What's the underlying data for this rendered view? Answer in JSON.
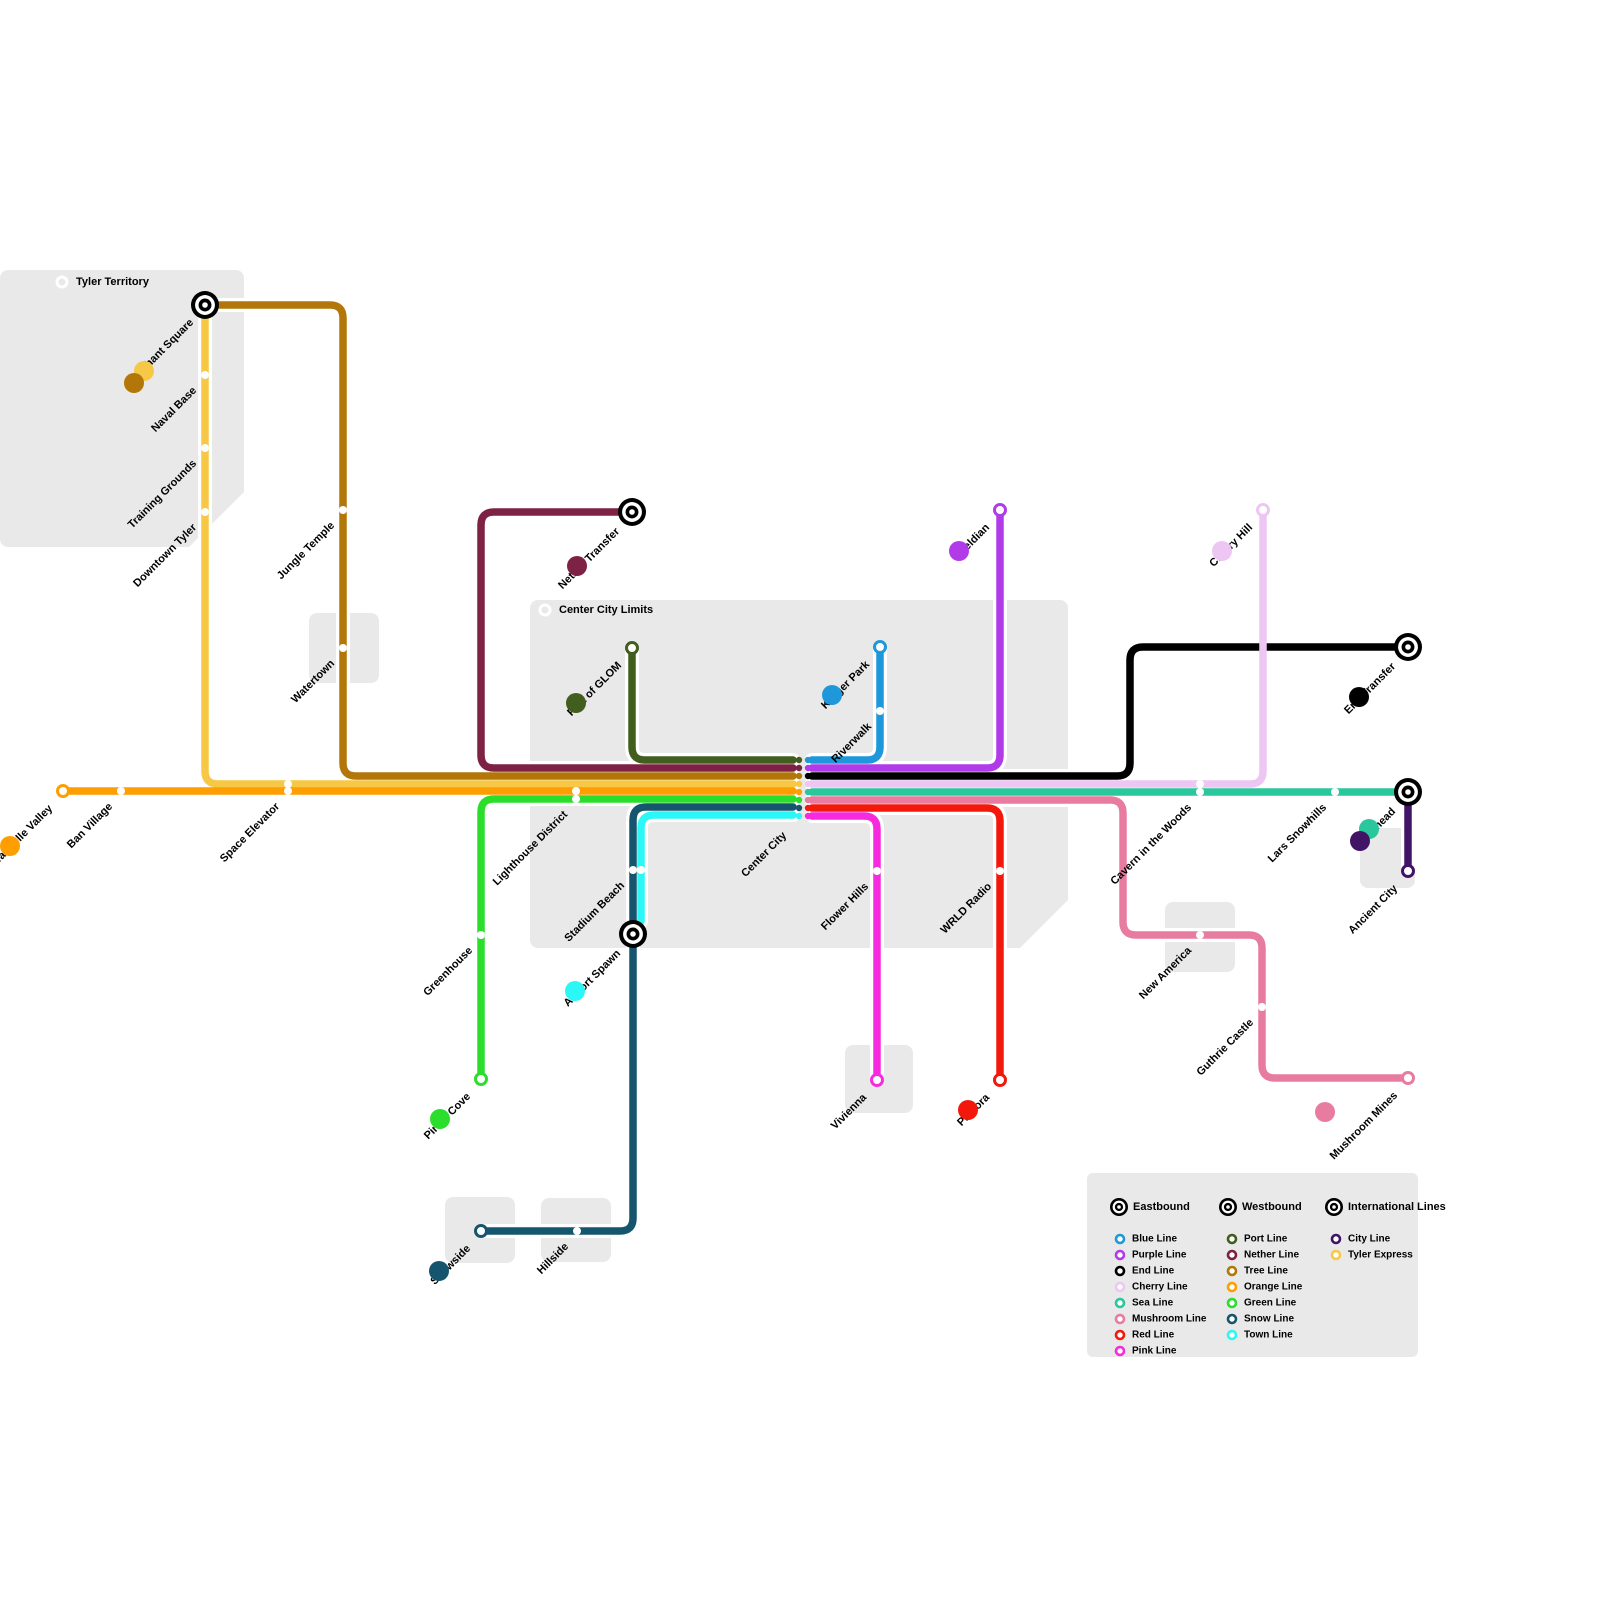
{
  "canvas": {
    "width": 1600,
    "height": 1600,
    "background": "#ffffff",
    "region_fill": "#e9e9e9"
  },
  "colors": {
    "blue": "#1E98DB",
    "purple": "#B13BE8",
    "end": "#000000",
    "cherry": "#EDC6F4",
    "sea": "#2BC79C",
    "mushroom": "#E87BA0",
    "red": "#F2190C",
    "pink": "#F72BDE",
    "port": "#415E1F",
    "nether": "#7D2145",
    "tree": "#B27708",
    "orange": "#FF9E00",
    "green": "#2BDE2B",
    "snow": "#15566E",
    "town": "#2BF7F7",
    "city": "#421466",
    "tyler": "#F7C845"
  },
  "regions": [
    {
      "name": "tyler-territory-area",
      "x": 0,
      "y": 270,
      "w": 244,
      "h": 277
    },
    {
      "name": "watertown-area",
      "x": 309,
      "y": 613,
      "w": 70,
      "h": 70
    },
    {
      "name": "center-city-limits-area",
      "x": 530,
      "y": 600,
      "w": 538,
      "h": 348
    },
    {
      "name": "vivienna-area",
      "x": 845,
      "y": 1045,
      "w": 68,
      "h": 68
    },
    {
      "name": "new-america-area",
      "x": 1165,
      "y": 902,
      "w": 70,
      "h": 70
    },
    {
      "name": "ancient-city-area",
      "x": 1360,
      "y": 828,
      "w": 55,
      "h": 60
    },
    {
      "name": "snowside-area",
      "x": 445,
      "y": 1197,
      "w": 70,
      "h": 66
    },
    {
      "name": "hillside-area",
      "x": 541,
      "y": 1198,
      "w": 70,
      "h": 64
    }
  ],
  "chamfers": [
    {
      "points": [
        [
          244,
          492
        ],
        [
          244,
          547
        ],
        [
          189,
          547
        ]
      ]
    },
    {
      "points": [
        [
          1068,
          900
        ],
        [
          1068,
          948
        ],
        [
          1020,
          948
        ]
      ]
    }
  ],
  "region_labels": [
    {
      "label": "Tyler Territory",
      "ring": [
        62,
        282
      ],
      "text": [
        76,
        282
      ]
    },
    {
      "label": "Center City Limits",
      "ring": [
        545,
        610
      ],
      "text": [
        559,
        610
      ]
    }
  ],
  "lines": [
    {
      "id": "tyler-express",
      "label": "Tyler Express",
      "color": "#F7C845",
      "points": [
        [
          205,
          305
        ],
        [
          205,
          784
        ],
        [
          793,
          784
        ]
      ]
    },
    {
      "id": "tree-line",
      "label": "Tree Line",
      "color": "#B27708",
      "points": [
        [
          205,
          305
        ],
        [
          343,
          305
        ],
        [
          343,
          776
        ],
        [
          793,
          776
        ]
      ]
    },
    {
      "id": "nether-line",
      "label": "Nether Line",
      "color": "#7D2145",
      "points": [
        [
          632,
          512
        ],
        [
          481,
          512
        ],
        [
          481,
          768
        ],
        [
          793,
          768
        ]
      ]
    },
    {
      "id": "port-line",
      "label": "Port Line",
      "color": "#415E1F",
      "points": [
        [
          632,
          648
        ],
        [
          632,
          760
        ],
        [
          793,
          760
        ]
      ]
    },
    {
      "id": "orange-line",
      "label": "Orange Line",
      "color": "#FF9E00",
      "points": [
        [
          63,
          791
        ],
        [
          793,
          791
        ]
      ]
    },
    {
      "id": "green-line",
      "label": "Green Line",
      "color": "#2BDE2B",
      "points": [
        [
          793,
          799
        ],
        [
          481,
          799
        ],
        [
          481,
          1079
        ]
      ]
    },
    {
      "id": "snow-line",
      "label": "Snow Line",
      "color": "#15566E",
      "points": [
        [
          793,
          807
        ],
        [
          633,
          807
        ],
        [
          633,
          1231
        ],
        [
          481,
          1231
        ]
      ]
    },
    {
      "id": "town-line",
      "label": "Town Line",
      "color": "#2BF7F7",
      "points": [
        [
          793,
          815
        ],
        [
          641,
          815
        ],
        [
          641,
          921
        ]
      ]
    },
    {
      "id": "blue-line",
      "label": "Blue Line",
      "color": "#1E98DB",
      "points": [
        [
          880,
          647
        ],
        [
          880,
          760
        ],
        [
          812,
          760
        ]
      ]
    },
    {
      "id": "purple-line",
      "label": "Purple Line",
      "color": "#B13BE8",
      "points": [
        [
          812,
          768
        ],
        [
          1000,
          768
        ],
        [
          1000,
          510
        ]
      ]
    },
    {
      "id": "end-line",
      "label": "End Line",
      "color": "#000000",
      "points": [
        [
          812,
          776
        ],
        [
          1130,
          776
        ],
        [
          1130,
          647
        ],
        [
          1408,
          647
        ]
      ]
    },
    {
      "id": "cherry-line",
      "label": "Cherry Line",
      "color": "#EDC6F4",
      "points": [
        [
          812,
          784
        ],
        [
          1263,
          784
        ],
        [
          1263,
          510
        ]
      ]
    },
    {
      "id": "sea-line",
      "label": "Sea Line",
      "color": "#2BC79C",
      "points": [
        [
          812,
          792
        ],
        [
          1408,
          792
        ]
      ]
    },
    {
      "id": "mushroom-line",
      "label": "Mushroom Line",
      "color": "#E87BA0",
      "points": [
        [
          812,
          800
        ],
        [
          1123,
          800
        ],
        [
          1123,
          935
        ],
        [
          1262,
          935
        ],
        [
          1262,
          1078
        ],
        [
          1408,
          1078
        ]
      ]
    },
    {
      "id": "red-line",
      "label": "Red Line",
      "color": "#F2190C",
      "points": [
        [
          812,
          808
        ],
        [
          1000,
          808
        ],
        [
          1000,
          1080
        ]
      ]
    },
    {
      "id": "pink-line",
      "label": "Pink Line",
      "color": "#F72BDE",
      "points": [
        [
          812,
          816
        ],
        [
          877,
          816
        ],
        [
          877,
          1080
        ]
      ]
    },
    {
      "id": "city-line",
      "label": "City Line",
      "color": "#421466",
      "points": [
        [
          1408,
          792
        ],
        [
          1408,
          871
        ]
      ]
    }
  ],
  "interchange": {
    "label": "Center City",
    "anchor": [
      787,
      836
    ],
    "columns": [
      {
        "x": 799,
        "start_y": 760,
        "step": 8,
        "colors": [
          "#415E1F",
          "#7D2145",
          "#B27708",
          "#F7C845",
          "#FF9E00",
          "#2BDE2B",
          "#15566E",
          "#2BF7F7"
        ]
      },
      {
        "x": 808,
        "start_y": 760,
        "step": 8,
        "colors": [
          "#1E98DB",
          "#B13BE8",
          "#000000",
          "#EDC6F4",
          "#2BC79C",
          "#E87BA0",
          "#F2190C",
          "#F72BDE"
        ]
      }
    ]
  },
  "stops": [
    {
      "label": "Naval Base",
      "dots": [
        [
          205,
          375
        ]
      ],
      "anchor": [
        197,
        391
      ]
    },
    {
      "label": "Training Grounds",
      "dots": [
        [
          205,
          448
        ]
      ],
      "anchor": [
        197,
        464
      ]
    },
    {
      "label": "Downtown Tyler",
      "dots": [
        [
          205,
          512
        ]
      ],
      "anchor": [
        197,
        528
      ]
    },
    {
      "label": "Jungle Temple",
      "dots": [
        [
          343,
          510
        ]
      ],
      "anchor": [
        335,
        526
      ]
    },
    {
      "label": "Watertown",
      "dots": [
        [
          343,
          648
        ]
      ],
      "anchor": [
        335,
        664
      ]
    },
    {
      "label": "Ban Village",
      "dots": [
        [
          121,
          791
        ]
      ],
      "anchor": [
        113,
        807
      ]
    },
    {
      "label": "Space Elevator",
      "dots": [
        [
          288,
          784
        ],
        [
          288,
          791
        ]
      ],
      "anchor": [
        280,
        807
      ]
    },
    {
      "label": "Lighthouse District",
      "dots": [
        [
          576,
          791
        ],
        [
          576,
          799
        ]
      ],
      "anchor": [
        568,
        815
      ]
    },
    {
      "label": "Greenhouse",
      "dots": [
        [
          481,
          935
        ]
      ],
      "anchor": [
        473,
        951
      ]
    },
    {
      "label": "Stadium Beach",
      "dots": [
        [
          633,
          870
        ],
        [
          641,
          870
        ]
      ],
      "anchor": [
        625,
        886
      ]
    },
    {
      "label": "Hillside",
      "dots": [
        [
          577,
          1231
        ]
      ],
      "anchor": [
        569,
        1247
      ]
    },
    {
      "label": "Riverwalk",
      "dots": [
        [
          880,
          711
        ]
      ],
      "anchor": [
        872,
        727
      ]
    },
    {
      "label": "Flower Hills",
      "dots": [
        [
          877,
          871
        ]
      ],
      "anchor": [
        869,
        887
      ]
    },
    {
      "label": "WRLD Radio",
      "dots": [
        [
          1000,
          871
        ]
      ],
      "anchor": [
        992,
        887
      ]
    },
    {
      "label": "Cavern in the Woods",
      "dots": [
        [
          1200,
          784
        ],
        [
          1200,
          792
        ]
      ],
      "anchor": [
        1192,
        808
      ]
    },
    {
      "label": "Lars Snowhills",
      "dots": [
        [
          1335,
          792
        ]
      ],
      "anchor": [
        1327,
        808
      ]
    },
    {
      "label": "New America",
      "dots": [
        [
          1200,
          935
        ]
      ],
      "anchor": [
        1192,
        951
      ]
    },
    {
      "label": "Guthrie Castle",
      "dots": [
        [
          1262,
          1007
        ]
      ],
      "anchor": [
        1254,
        1023
      ]
    }
  ],
  "termini": [
    {
      "label": "Wandelle Valley",
      "x": 63,
      "y": 791,
      "color": "#FF9E00",
      "anchor": [
        53,
        809
      ]
    },
    {
      "label": "Pirate Cove",
      "x": 481,
      "y": 1079,
      "color": "#2BDE2B",
      "anchor": [
        471,
        1097
      ]
    },
    {
      "label": "Snowside",
      "x": 481,
      "y": 1231,
      "color": "#15566E",
      "anchor": [
        471,
        1249
      ]
    },
    {
      "label": "Port of GLOM",
      "x": 632,
      "y": 648,
      "color": "#415E1F",
      "anchor": [
        622,
        666
      ]
    },
    {
      "label": "Kroger Park",
      "x": 880,
      "y": 647,
      "color": "#1E98DB",
      "anchor": [
        870,
        665
      ]
    },
    {
      "label": "Wyeldian",
      "x": 1000,
      "y": 510,
      "color": "#B13BE8",
      "anchor": [
        990,
        528
      ]
    },
    {
      "label": "Cherry Hill",
      "x": 1263,
      "y": 510,
      "color": "#EDC6F4",
      "anchor": [
        1253,
        528
      ]
    },
    {
      "label": "Vivienna",
      "x": 877,
      "y": 1080,
      "color": "#F72BDE",
      "anchor": [
        867,
        1098
      ]
    },
    {
      "label": "Pastora",
      "x": 1000,
      "y": 1080,
      "color": "#F2190C",
      "anchor": [
        990,
        1098
      ]
    },
    {
      "label": "Ancient City",
      "x": 1408,
      "y": 871,
      "color": "#421466",
      "anchor": [
        1398,
        889
      ]
    },
    {
      "label": "Mushroom Mines",
      "x": 1408,
      "y": 1078,
      "color": "#E87BA0",
      "anchor": [
        1398,
        1096
      ]
    }
  ],
  "hubs": [
    {
      "label": "Merchant Square",
      "x": 205,
      "y": 305,
      "anchor": [
        194,
        323
      ]
    },
    {
      "label": "Nether Transfer",
      "x": 632,
      "y": 512,
      "anchor": [
        620,
        532
      ]
    },
    {
      "label": "Airport Spawn",
      "x": 633,
      "y": 934,
      "anchor": [
        621,
        954
      ]
    },
    {
      "label": "End Transfer",
      "x": 1408,
      "y": 647,
      "anchor": [
        1396,
        667
      ]
    },
    {
      "label": "Oceghead",
      "x": 1408,
      "y": 792,
      "anchor": [
        1396,
        812
      ]
    }
  ],
  "badges": [
    {
      "name": "tyler-express-badge",
      "color": "#F7C845",
      "x": 144,
      "y": 371
    },
    {
      "name": "tree-line-badge",
      "color": "#B27708",
      "x": 134,
      "y": 383
    },
    {
      "name": "nether-line-badge",
      "color": "#7D2145",
      "x": 577,
      "y": 566
    },
    {
      "name": "port-line-badge",
      "color": "#415E1F",
      "x": 576,
      "y": 703
    },
    {
      "name": "blue-line-badge",
      "color": "#1E98DB",
      "x": 832,
      "y": 695
    },
    {
      "name": "purple-line-badge",
      "color": "#B13BE8",
      "x": 959,
      "y": 551
    },
    {
      "name": "cherry-line-badge",
      "color": "#EDC6F4",
      "x": 1222,
      "y": 551
    },
    {
      "name": "end-line-badge",
      "color": "#000000",
      "x": 1359,
      "y": 697
    },
    {
      "name": "sea-line-badge",
      "color": "#2BC79C",
      "x": 1369,
      "y": 829
    },
    {
      "name": "city-line-badge",
      "color": "#421466",
      "x": 1360,
      "y": 841
    },
    {
      "name": "orange-line-badge",
      "color": "#FF9E00",
      "x": 10,
      "y": 846
    },
    {
      "name": "green-line-badge",
      "color": "#2BDE2B",
      "x": 440,
      "y": 1119
    },
    {
      "name": "town-line-badge",
      "color": "#2BF7F7",
      "x": 575,
      "y": 991
    },
    {
      "name": "snow-line-badge",
      "color": "#15566E",
      "x": 439,
      "y": 1271
    },
    {
      "name": "red-line-badge",
      "color": "#F2190C",
      "x": 968,
      "y": 1110
    },
    {
      "name": "mushroom-line-badge",
      "color": "#E87BA0",
      "x": 1325,
      "y": 1112
    }
  ],
  "legend": {
    "box": {
      "x": 1087,
      "y": 1173,
      "w": 331,
      "h": 184
    },
    "headers": [
      {
        "label": "Eastbound",
        "icon": [
          1119,
          1207
        ],
        "text": [
          1133,
          1207
        ]
      },
      {
        "label": "Westbound",
        "icon": [
          1228,
          1207
        ],
        "text": [
          1242,
          1207
        ]
      },
      {
        "label": "International Lines",
        "icon": [
          1334,
          1207
        ],
        "text": [
          1348,
          1207
        ]
      }
    ],
    "columns": [
      {
        "bullet_x": 1120,
        "text_x": 1132,
        "start_y": 1239,
        "step": 16,
        "items": [
          {
            "label": "Blue Line",
            "color": "#1E98DB"
          },
          {
            "label": "Purple Line",
            "color": "#B13BE8"
          },
          {
            "label": "End Line",
            "color": "#000000"
          },
          {
            "label": "Cherry Line",
            "color": "#EDC6F4"
          },
          {
            "label": "Sea Line",
            "color": "#2BC79C"
          },
          {
            "label": "Mushroom Line",
            "color": "#E87BA0"
          },
          {
            "label": "Red Line",
            "color": "#F2190C"
          },
          {
            "label": "Pink Line",
            "color": "#F72BDE"
          }
        ]
      },
      {
        "bullet_x": 1232,
        "text_x": 1244,
        "start_y": 1239,
        "step": 16,
        "items": [
          {
            "label": "Port Line",
            "color": "#415E1F"
          },
          {
            "label": "Nether Line",
            "color": "#7D2145"
          },
          {
            "label": "Tree Line",
            "color": "#B27708"
          },
          {
            "label": "Orange Line",
            "color": "#FF9E00"
          },
          {
            "label": "Green Line",
            "color": "#2BDE2B"
          },
          {
            "label": "Snow Line",
            "color": "#15566E"
          },
          {
            "label": "Town Line",
            "color": "#2BF7F7"
          }
        ]
      },
      {
        "bullet_x": 1336,
        "text_x": 1348,
        "start_y": 1239,
        "step": 16,
        "items": [
          {
            "label": "City Line",
            "color": "#421466"
          },
          {
            "label": "Tyler Express",
            "color": "#F7C845"
          }
        ]
      }
    ]
  },
  "style": {
    "line_width": 7.5,
    "casing_width": 14,
    "corner_radius": 13,
    "stop_radius": 4,
    "terminus_radius": 5.5,
    "terminus_stroke": 3,
    "hub_radius": 14,
    "badge_radius": 10,
    "interchange_dot_radius": 3.2,
    "label_font_size": 11,
    "legend_item_font_size": 10
  }
}
